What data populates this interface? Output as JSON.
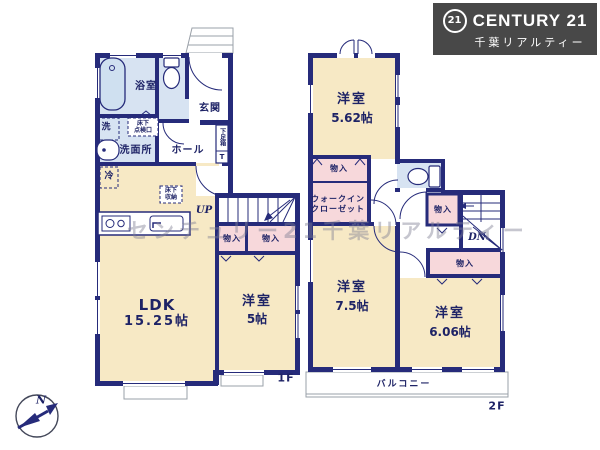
{
  "branding": {
    "circle": "21",
    "name": "CENTURY 21",
    "subtitle": "千葉リアルティー"
  },
  "watermark": "センチュリー21千葉リアルティー",
  "compass": {
    "north": "N"
  },
  "floor1": {
    "label": "1F",
    "ldk": {
      "name": "LDK",
      "size": "15.25帖"
    },
    "bedroom": {
      "name": "洋室",
      "size": "5帖"
    },
    "bathroom": "浴室",
    "washer": "洗",
    "inspection": [
      "床下",
      "点検口"
    ],
    "washroom": "洗面所",
    "entrance": "玄関",
    "shoebox": "下足箱",
    "shoebox_t": "T",
    "hall": "ホール",
    "fridge": "冷",
    "floor_storage": [
      "床下",
      "収納"
    ],
    "stairs_up": "UP",
    "closets": [
      "物入",
      "物入"
    ]
  },
  "floor2": {
    "label": "2F",
    "bedroom_a": {
      "name": "洋室",
      "size": "5.62帖"
    },
    "bedroom_b": {
      "name": "洋室",
      "size": "7.5帖"
    },
    "bedroom_c": {
      "name": "洋室",
      "size": "6.06帖"
    },
    "walkin_closet": [
      "ウォークイン",
      "クローゼット"
    ],
    "closets": [
      "物入",
      "物入",
      "物入"
    ],
    "stairs_down": "DN",
    "balcony": "バルコニー"
  }
}
